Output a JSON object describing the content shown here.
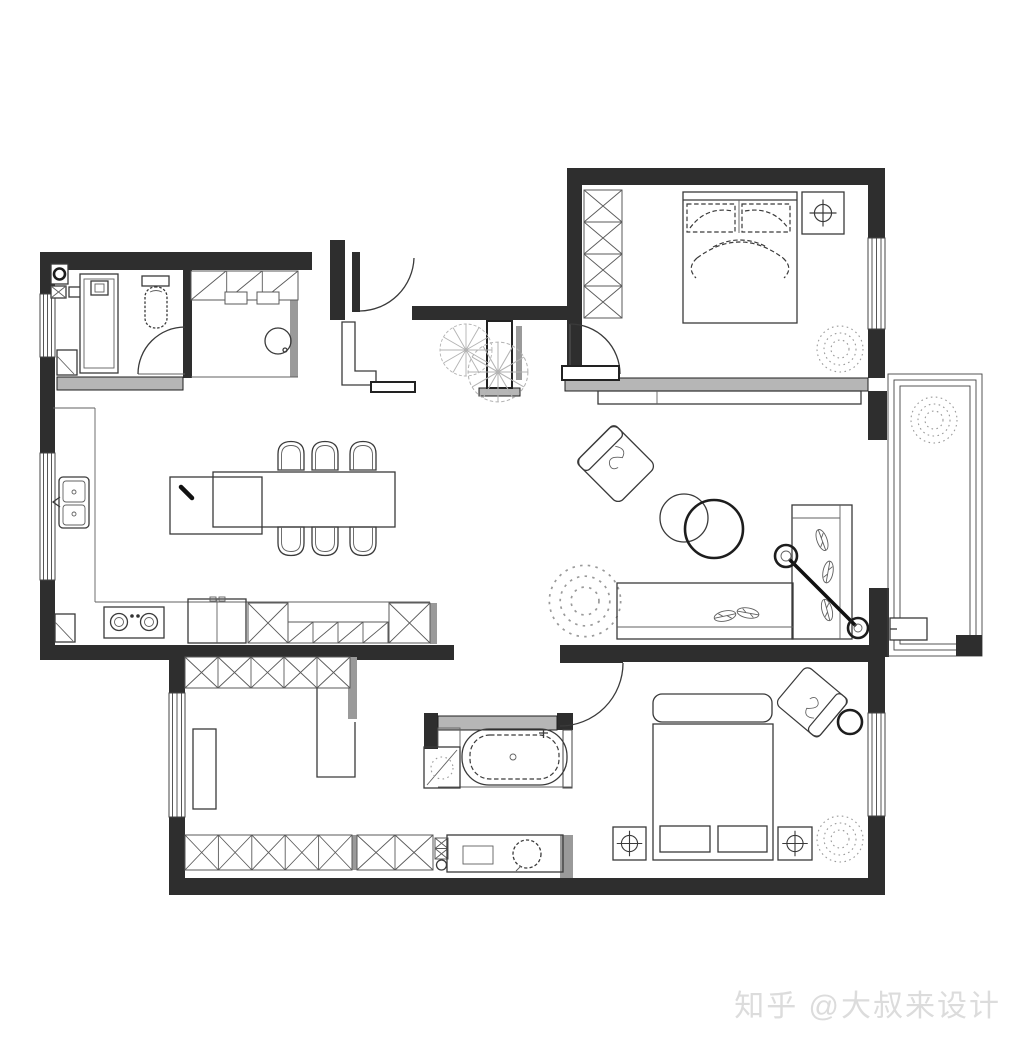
{
  "watermark": {
    "text": "知乎 @大叔来设计",
    "color": "#dcdcdc"
  },
  "palette": {
    "background": "#ffffff",
    "wall": "#2e2e2e",
    "sill_gray": "#b6b6b6",
    "drawing_line": "#3a3a3a",
    "hatch_line": "#5a5a5a",
    "plant_dots": "#9a9a9a",
    "watermark": "#dcdcdc"
  },
  "plan": {
    "type": "residential floor plan (plan view, no dimension text)",
    "rooms": [
      {
        "name": "bathroom-top-left",
        "items": [
          "washing-unit",
          "shower-cabin",
          "toilet",
          "swing-door",
          "window"
        ]
      },
      {
        "name": "closet-top-left",
        "items": [
          "hatched-cabinets",
          "round-wash-basin"
        ]
      },
      {
        "name": "entry-hall",
        "items": [
          "entry-door",
          "shoe-cabinet",
          "bench",
          "fan-plants",
          "partition-stub"
        ]
      },
      {
        "name": "master-bedroom",
        "items": [
          "x-hatch-wardrobe",
          "double-bed",
          "nightstand-with-lamp-symbol",
          "plant",
          "window",
          "swing-door",
          "gray-sill",
          "tv-cabinet"
        ]
      },
      {
        "name": "kitchen-dining",
        "items": [
          "double-sink",
          "island-counter",
          "dining-table",
          "six-chairs",
          "two-burner-cooktop",
          "fridge",
          "x-hatch-cabinets",
          "drawer-cabinets",
          "windows"
        ]
      },
      {
        "name": "living-room",
        "items": [
          "rotated-armchair",
          "two-round-tables",
          "l-shaped-sofa",
          "leaf-cushions",
          "arc-floor-lamp",
          "plant"
        ]
      },
      {
        "name": "balcony",
        "items": [
          "window-frames",
          "plant",
          "ac-unit",
          "corner-post"
        ]
      },
      {
        "name": "study-cloakroom",
        "items": [
          "x-hatch-wardrobe-top",
          "x-hatch-wardrobe-bottom",
          "desk",
          "l-counter",
          "window"
        ]
      },
      {
        "name": "bathroom-bottom",
        "items": [
          "freestanding-bathtub",
          "shower-corner",
          "niche",
          "vanity-with-round-basin",
          "x-hatch-column"
        ]
      },
      {
        "name": "second-bedroom",
        "items": [
          "double-bed",
          "two-nightstands-with-lamp-symbols",
          "rotated-armchair",
          "round-side-table",
          "plant",
          "window",
          "swing-door"
        ]
      }
    ]
  }
}
